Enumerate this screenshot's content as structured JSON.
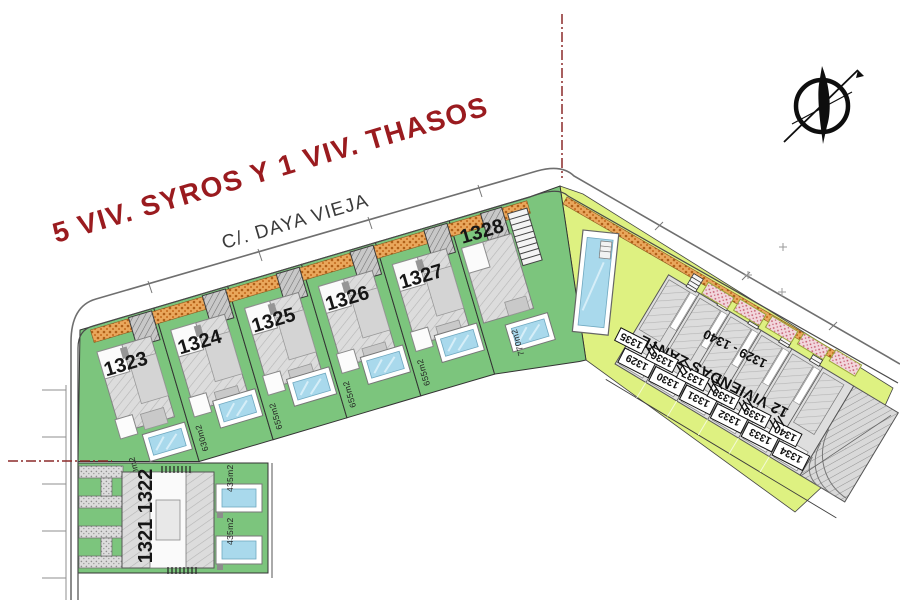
{
  "title": "5 VIV. SYROS Y 1 VIV. THASOS",
  "street_label": "C/. DAYA VIEJA",
  "plots": [
    {
      "number": "1323",
      "area": "700m2"
    },
    {
      "number": "1324",
      "area": "630m2"
    },
    {
      "number": "1325",
      "area": "655m2"
    },
    {
      "number": "1326",
      "area": "655m2"
    },
    {
      "number": "1327",
      "area": "655m2"
    },
    {
      "number": "1328",
      "area": "770m2"
    }
  ],
  "duplex": {
    "number": "1321 1322",
    "area_top": "435m2",
    "area_bottom": "435m2"
  },
  "zante": {
    "name": "12 VIVIENDAS ZANTE",
    "range": "1329 - 1340",
    "front_units": [
      "1329",
      "1330",
      "1331",
      "1332",
      "1333",
      "1334"
    ],
    "box_units": [
      "1335",
      "1336",
      "1337",
      "1338",
      "1339",
      "1340"
    ]
  },
  "colors": {
    "plot_green": "#7cc57d",
    "communal_lime": "#def181",
    "pool_blue": "#a9d9ec",
    "driveway_orange": "#e9a75c",
    "terrace_pink": "#f2d7dd",
    "title_red": "#9a1b1f",
    "boundary_red": "#8b2a2a"
  }
}
